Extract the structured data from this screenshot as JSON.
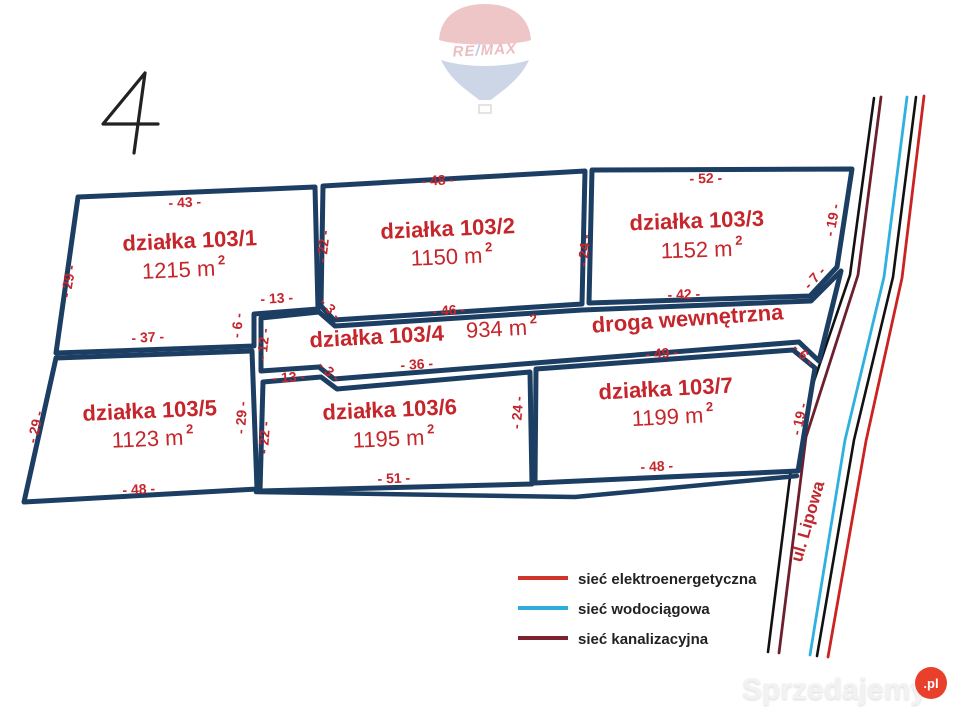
{
  "page_number": "4",
  "remax": {
    "re": "RE",
    "slash": "/",
    "max": "MAX"
  },
  "plots": {
    "p1": {
      "name": "działka 103/1",
      "area": "1215 m",
      "sup": "2"
    },
    "p2": {
      "name": "działka 103/2",
      "area": "1150 m",
      "sup": "2"
    },
    "p3": {
      "name": "działka 103/3",
      "area": "1152 m",
      "sup": "2"
    },
    "p4": {
      "name": "działka 103/4",
      "area": "934 m",
      "sup": "2"
    },
    "p5": {
      "name": "działka 103/5",
      "area": "1123 m",
      "sup": "2"
    },
    "p6": {
      "name": "działka 103/6",
      "area": "1195 m",
      "sup": "2"
    },
    "p7": {
      "name": "działka 103/7",
      "area": "1199 m",
      "sup": "2"
    }
  },
  "road_label": "droga wewnętrzna",
  "street_label": "ul. Lipowa",
  "measurements": {
    "p1_top": "- 43 -",
    "p1_left": "- 29 -",
    "p1_bottom": "- 37 -",
    "p1_notch_top": "- 13 -",
    "p1_notch_side": "- 6 -",
    "p1_p2_divider": "- 22 -",
    "p2_top": "- 48 -",
    "p2_bottom": "- 46 -",
    "p2_diag": "- 3 -",
    "p2_p3_divider": "- 24 -",
    "p3_top": "- 52 -",
    "p3_bottom": "- 42 -",
    "p3_right": "- 19 -",
    "p3_diag": "- 7 -",
    "p4_left": "- 12 -",
    "p4_bottom_left": "- 13 -",
    "p4_bottom_diag": "- 3 -",
    "p4_bottom": "- 36 -",
    "p5_left": "- 29 -",
    "p5_right": "- 29 -",
    "p5_bottom": "- 48 -",
    "p6_left": "- 22 -",
    "p6_right": "- 24 -",
    "p6_bottom": "- 51 -",
    "p7_top": "- 49 -",
    "p7_diag": "- 6 -",
    "p7_right": "- 19 -",
    "p7_bottom": "- 48 -"
  },
  "legend": {
    "items": [
      {
        "label": "sieć elektroenergetyczna",
        "color": "#d1342b"
      },
      {
        "label": "sieć wodociągowa",
        "color": "#31aadc"
      },
      {
        "label": "sieć kanalizacyjna",
        "color": "#7c2130"
      }
    ]
  },
  "watermark": {
    "brand": "Sprzedajemy",
    "tld": ".pl"
  },
  "colors": {
    "boundary": "#1c3e63",
    "label_red": "#c5262c"
  }
}
